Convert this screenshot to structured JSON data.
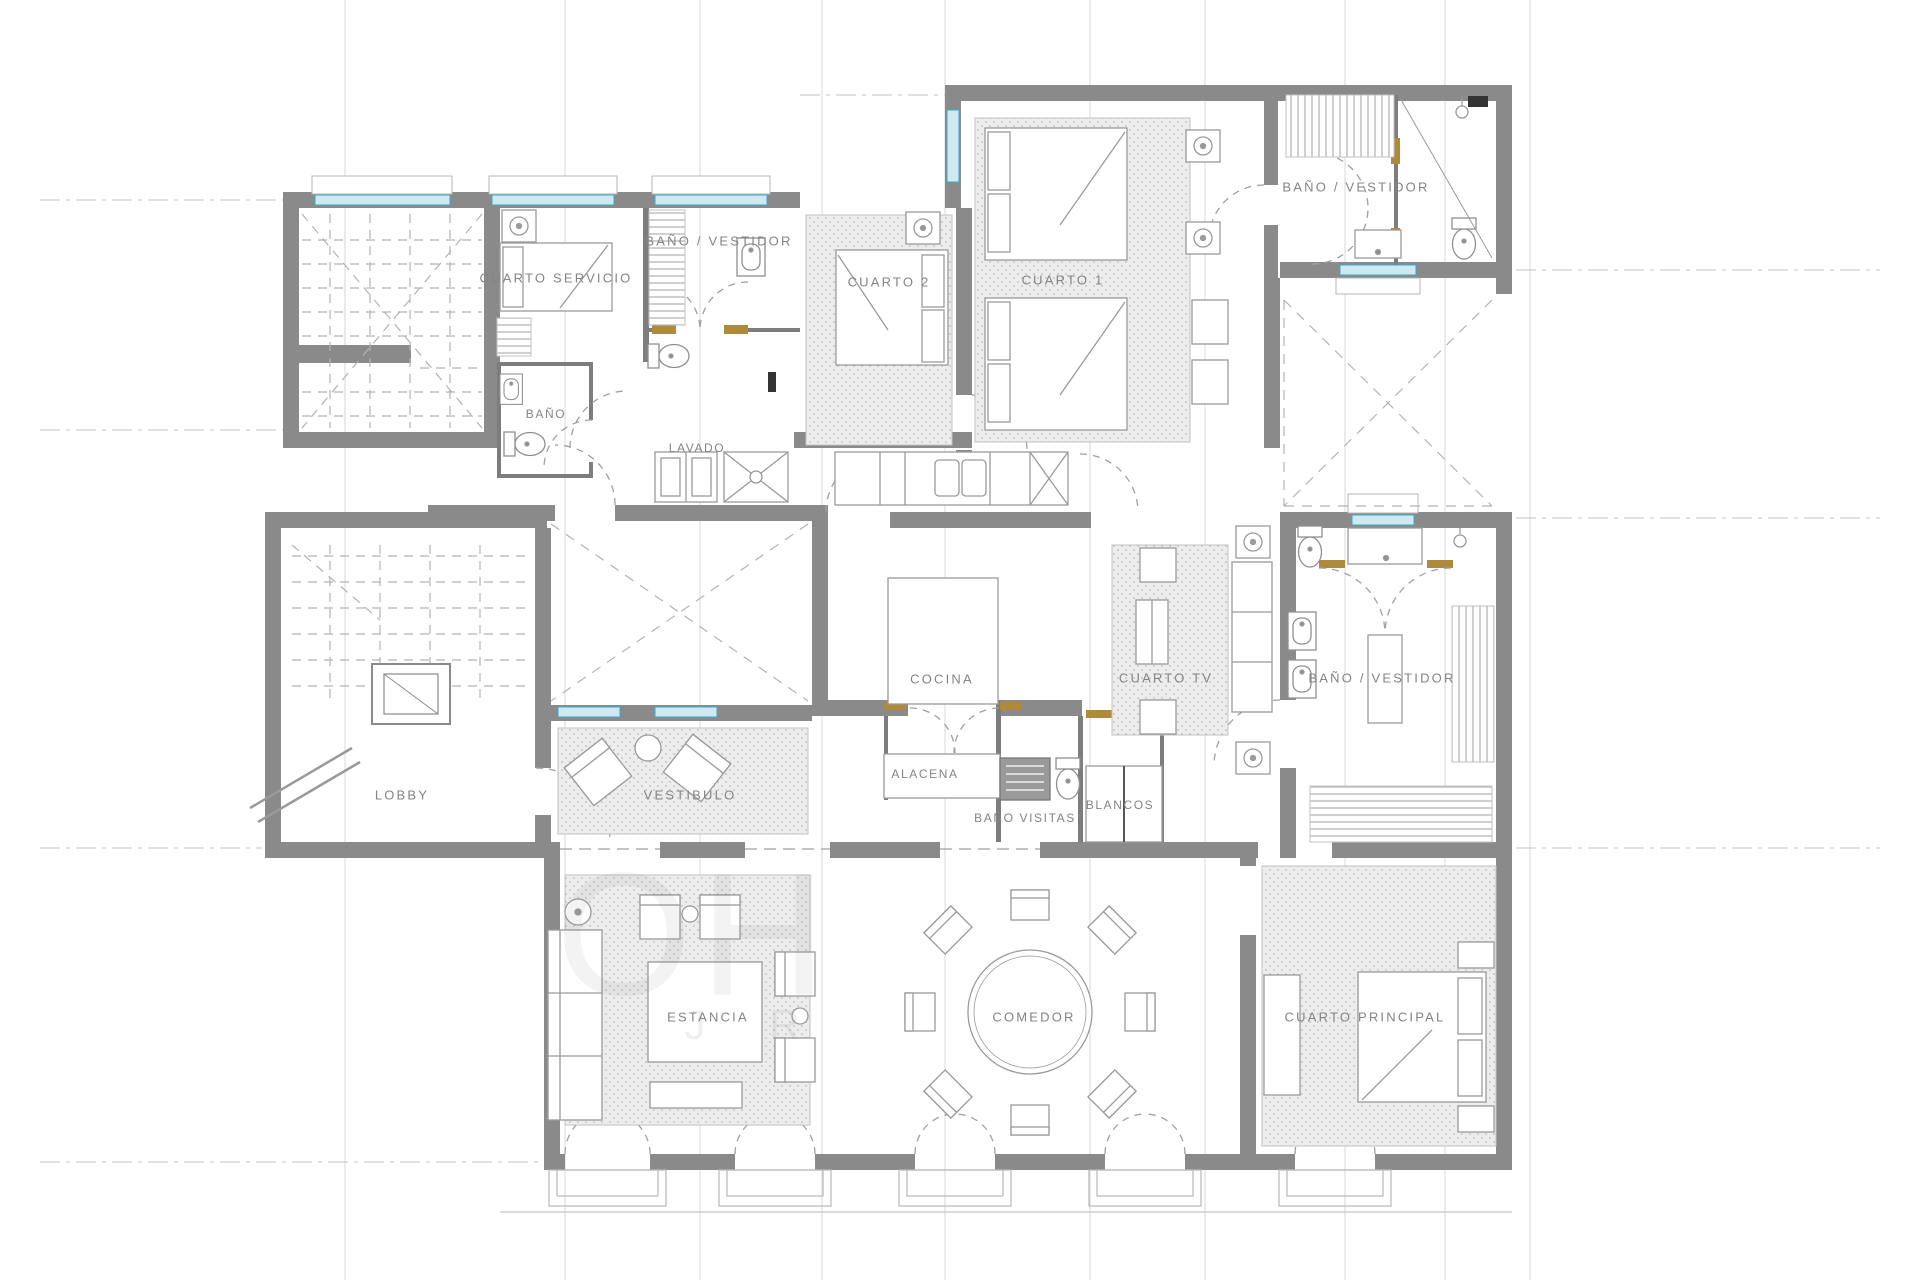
{
  "plan": {
    "labels": [
      {
        "id": "cuarto-servicio",
        "text": "CUARTO  SERVICIO"
      },
      {
        "id": "bano-vestidor-servicio",
        "text": "BAÑO  /  VESTIDOR"
      },
      {
        "id": "cuarto-2",
        "text": "CUARTO  2"
      },
      {
        "id": "cuarto-1",
        "text": "CUARTO  1"
      },
      {
        "id": "bano-vestidor-cuarto1",
        "text": "BAÑO  /  VESTIDOR"
      },
      {
        "id": "bano",
        "text": "BAÑO"
      },
      {
        "id": "lavado",
        "text": "LAVADO"
      },
      {
        "id": "cocina",
        "text": "COCINA"
      },
      {
        "id": "cuarto-tv",
        "text": "CUARTO  TV"
      },
      {
        "id": "bano-vestidor-principal",
        "text": "BAÑO  /  VESTIDOR"
      },
      {
        "id": "lobby",
        "text": "LOBBY"
      },
      {
        "id": "vestibulo",
        "text": "VESTIBULO"
      },
      {
        "id": "alacena",
        "text": "ALACENA"
      },
      {
        "id": "bano-visitas",
        "text": "BAÑO  VISITAS"
      },
      {
        "id": "blancos",
        "text": "BLANCOS"
      },
      {
        "id": "estancia",
        "text": "ESTANCIA"
      },
      {
        "id": "comedor",
        "text": "COMEDOR"
      },
      {
        "id": "cuarto-principal",
        "text": "CUARTO  PRINCIPAL"
      }
    ],
    "watermark": {
      "line1": "OH",
      "line2": "J R"
    },
    "colors": {
      "wall": "#8a8a8a",
      "window_line": "#3fa8c4",
      "window_fill": "#cfe9f2",
      "furniture": "#9a9a9a",
      "door_wood": "#b08a3c",
      "grid": "#d9d9d9",
      "label": "#848484",
      "fixture_dark": "#333333"
    }
  }
}
